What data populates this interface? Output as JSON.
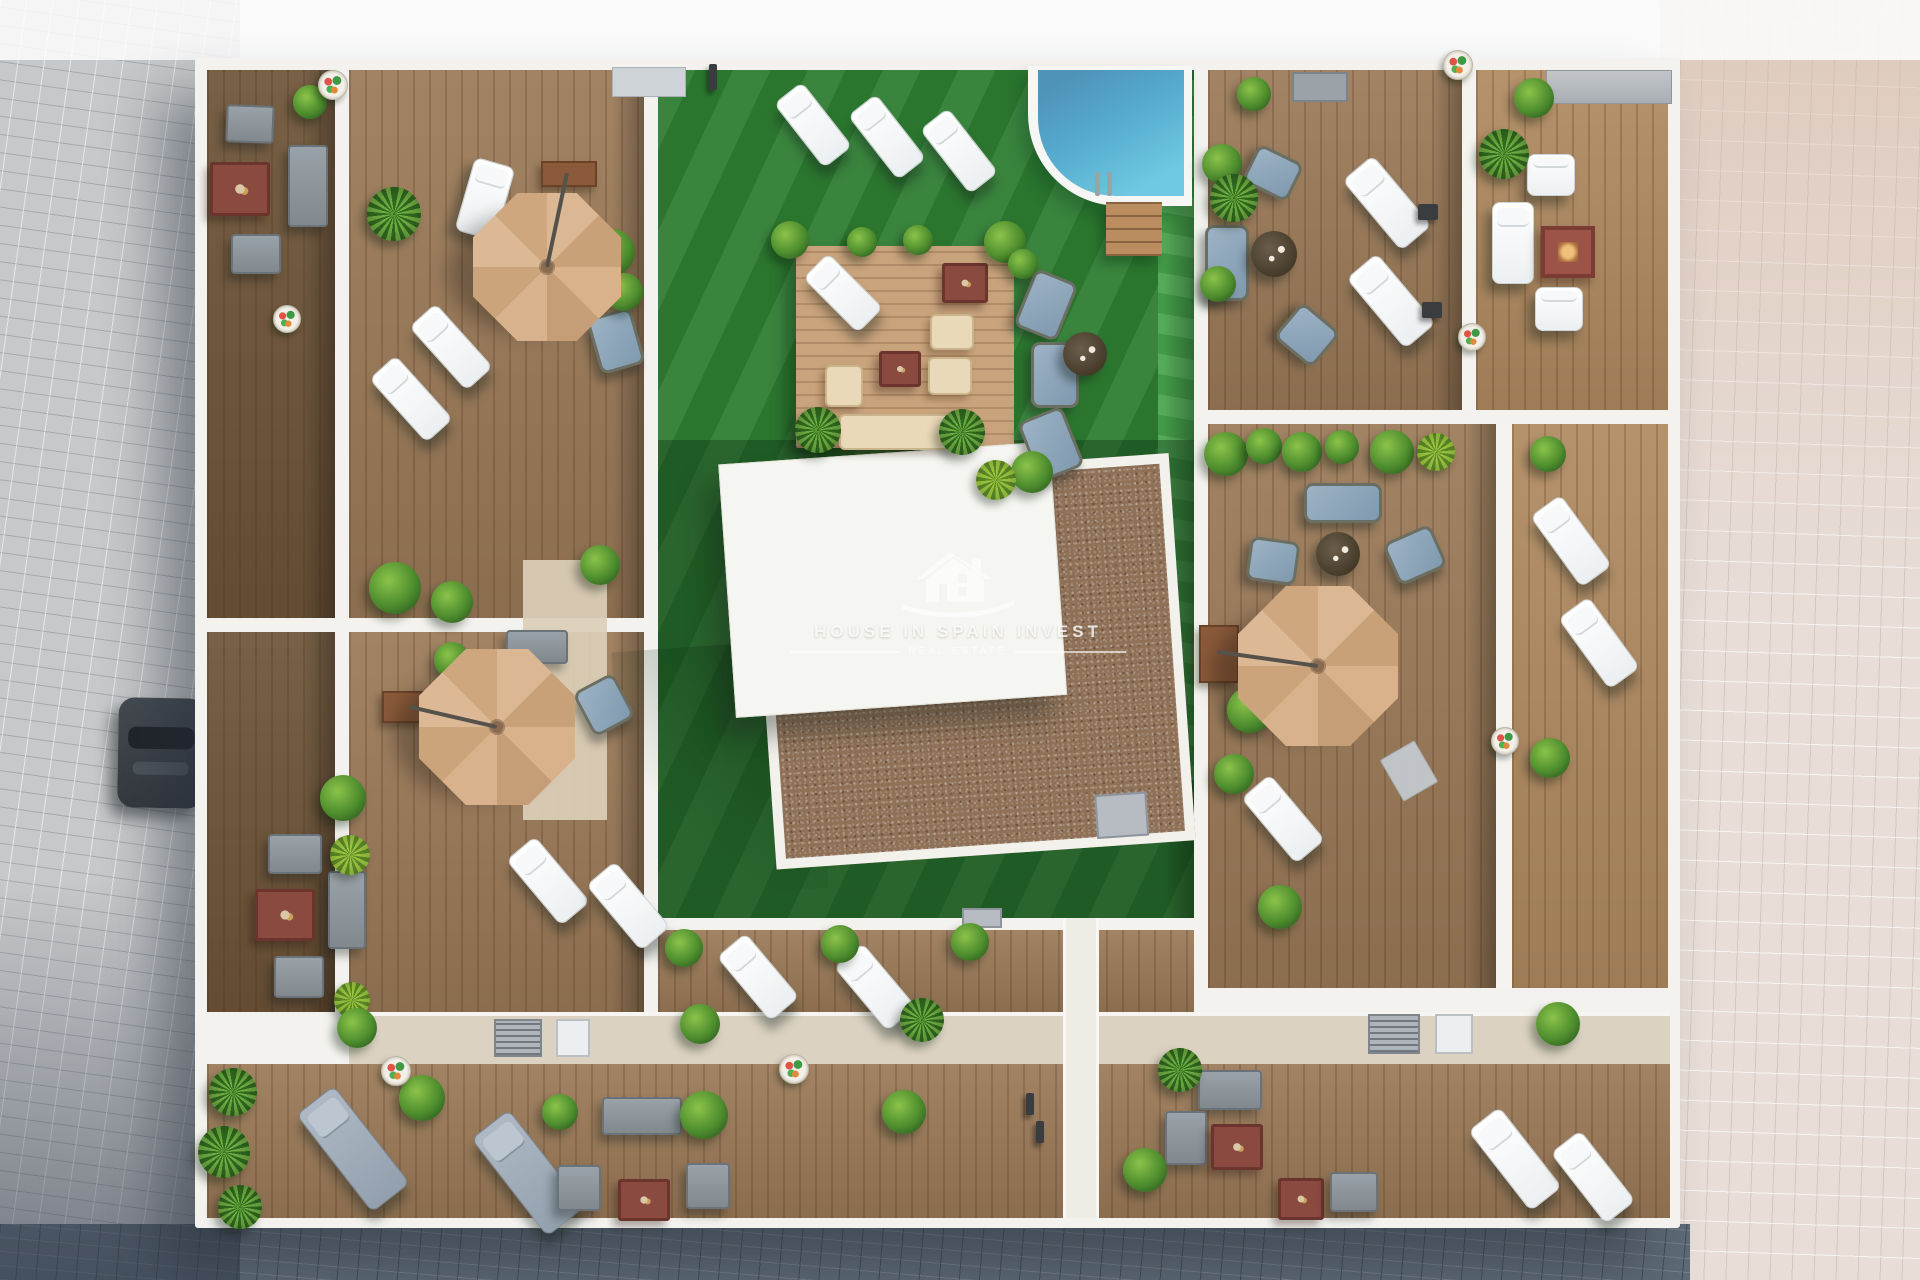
{
  "watermark": {
    "brand": "HOUSE IN SPAIN INVEST",
    "tagline": "REAL ESTATE",
    "logo_icon": "house-logo-icon"
  },
  "scene": {
    "description": "Aerial 3D architectural render: rooftop solarium plan of a residential building with communal turf courtyard, swimming pool, pergola lounge, and private wood-deck terraces separated by white walls",
    "areas": [
      {
        "name": "street-left",
        "surface": "grey stone paving"
      },
      {
        "name": "street-right",
        "surface": "light pink stone paving"
      },
      {
        "name": "street-bottom",
        "surface": "dark slate paving in building shadow"
      },
      {
        "name": "terrace-top-left",
        "surface": "wood deck"
      },
      {
        "name": "terrace-top-right",
        "surface": "wood deck"
      },
      {
        "name": "terrace-right-middle",
        "surface": "wood deck"
      },
      {
        "name": "terrace-left-middle",
        "surface": "wood deck"
      },
      {
        "name": "terrace-bottom-left",
        "surface": "wood deck"
      },
      {
        "name": "terrace-bottom-right",
        "surface": "wood deck"
      },
      {
        "name": "communal-courtyard",
        "surface": "artificial turf"
      },
      {
        "name": "swimming-pool",
        "surface": "water"
      },
      {
        "name": "pergola-lounge-deck",
        "surface": "light wood deck"
      },
      {
        "name": "stair-core-roof",
        "surface": "white flat roof"
      },
      {
        "name": "gravel-roof",
        "surface": "brown gravel"
      }
    ],
    "objects": [
      {
        "name": "cantilever-parasol",
        "count": 3
      },
      {
        "name": "white-sun-lounger",
        "count": 16
      },
      {
        "name": "grey-daybed",
        "count": 3
      },
      {
        "name": "blue-lounge-chair",
        "count": 8
      },
      {
        "name": "grey-sofa-set",
        "count": 3
      },
      {
        "name": "white-sofa-set",
        "count": 1
      },
      {
        "name": "red-coffee-table",
        "count": 6
      },
      {
        "name": "fire-table",
        "count": 1
      },
      {
        "name": "round-wicker-table",
        "count": 3
      },
      {
        "name": "pergola-sofa-set",
        "count": 1
      },
      {
        "name": "planter-flower-pot",
        "count": 9
      },
      {
        "name": "shrub-or-palm",
        "count": 34
      },
      {
        "name": "parked-car",
        "count": 1
      },
      {
        "name": "pool-steps",
        "count": 1
      },
      {
        "name": "ac-unit",
        "count": 4
      }
    ]
  },
  "palette": {
    "wood_deck": "#9b7a58",
    "wood_dark": "#6e5438",
    "wood_light": "#b08a60",
    "pergola_wood": "#c9a37c",
    "turf_green": "#2e7d32",
    "turf_bright": "#46a34a",
    "pool_water": "#56add0",
    "gravel": "#8f7158",
    "roof_white": "#f5f5f1",
    "parasol_tan": "#d4ac85",
    "street_grey": "#c6c8ca",
    "street_pink": "#e8ded7",
    "street_shadow": "#5e6a76",
    "accent_red_table": "#8a4a40",
    "cushion_blue": "#8fa6ba",
    "cushion_beige": "#ead9b8"
  }
}
